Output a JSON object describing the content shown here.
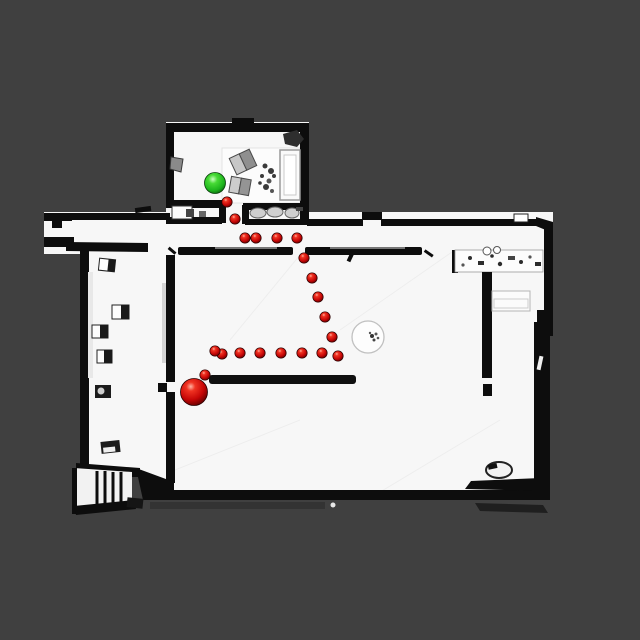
{
  "scene": {
    "view": "top-down-floorplan",
    "colors": {
      "background": "#404040",
      "floor": "#f7f7f7",
      "walls": "#0d0d0d",
      "path_red": "#cc1111",
      "goal_green": "#2fd32f"
    },
    "path": {
      "dot_radius": 5.2,
      "waypoints": [
        [
          227,
          202
        ],
        [
          235,
          219
        ],
        [
          245,
          238
        ],
        [
          256,
          238
        ],
        [
          277,
          238
        ],
        [
          297,
          238
        ],
        [
          304,
          258
        ],
        [
          312,
          278
        ],
        [
          318,
          297
        ],
        [
          325,
          317
        ],
        [
          332,
          337
        ],
        [
          338,
          356
        ],
        [
          322,
          353
        ],
        [
          302,
          353
        ],
        [
          281,
          353
        ],
        [
          260,
          353
        ],
        [
          240,
          353
        ],
        [
          222,
          354
        ],
        [
          215,
          351
        ],
        [
          205,
          375
        ]
      ]
    },
    "markers": {
      "red_sphere": {
        "x": 194,
        "y": 392,
        "radius": 13.5
      },
      "green_sphere": {
        "x": 215,
        "y": 183,
        "radius": 10.5
      }
    }
  }
}
